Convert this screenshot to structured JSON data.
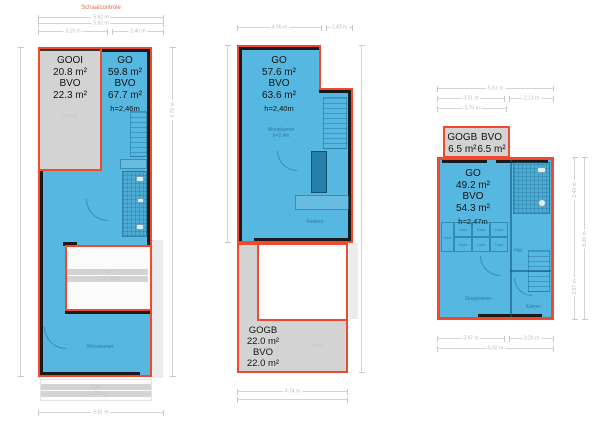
{
  "colors": {
    "blue": "#56b7e0",
    "red": "#f04a2e",
    "grey": "#d3d3d3",
    "wall": "#1a1a1a"
  },
  "scale_check": {
    "title": "Schaalcontrole",
    "total": "5.62 m",
    "total_2": "5.62 m",
    "seg_left": "3.19 m",
    "seg_right": "2.40 m"
  },
  "plan1": {
    "garage": {
      "type": "GOOI",
      "area": "20.8 m²",
      "type2": "BVO",
      "area2": "22.3 m²",
      "room": "Garage"
    },
    "main": {
      "type": "GO",
      "area": "59.8 m²",
      "type2": "BVO",
      "area2": "67.7 m²",
      "height": "h=2,46m"
    },
    "rooms": {
      "living": "Woonkamer",
      "courtyard": "Tuin",
      "courtyard_area": "Ca.17.2m2",
      "garden": "Tuin",
      "garden_area": "Ca.9.2m2"
    },
    "dims": {
      "bottom": "5.61 m",
      "right_top": "4.79 m"
    }
  },
  "plan2": {
    "main": {
      "type": "GO",
      "area": "57.6 m²",
      "type2": "BVO",
      "area2": "63.6 m²",
      "height": "h=2,40m"
    },
    "gogb": {
      "type": "GOGB",
      "area": "22.0 m²",
      "type2": "BVO",
      "area2": "22.0 m²"
    },
    "rooms": {
      "living": "Woonkamer",
      "living_height": "h=2.4m",
      "kitchen": "Keuken",
      "terrace": "Terras"
    },
    "dims": {
      "top_left": "4.95 m",
      "top_right": "1.43 m",
      "bottom": "4.74 m"
    }
  },
  "plan3": {
    "gogb": {
      "type": "GOGB",
      "area": "6.5 m²",
      "type2": "BVO",
      "area2": "6.5 m²"
    },
    "main": {
      "type": "GO",
      "area": "49.2 m²",
      "type2": "BVO",
      "area2": "54.3 m²",
      "height": "h=2,47m"
    },
    "rooms": {
      "bedroom": "Slaapkamer",
      "hall": "Hal",
      "room": "Kamer",
      "closet": "Kast"
    },
    "dims": {
      "top_total": "5.61 m",
      "top_left": "3.51 m",
      "top_right": "2.13 m",
      "top_inner": "3.79 m",
      "bottom_left": "3.97 m",
      "bottom_right": "3.20 m",
      "bottom_total": "5.92 m",
      "right_top": "2.43 m",
      "right_bottom": "2.57 m",
      "right_total": "8.26 m"
    }
  }
}
